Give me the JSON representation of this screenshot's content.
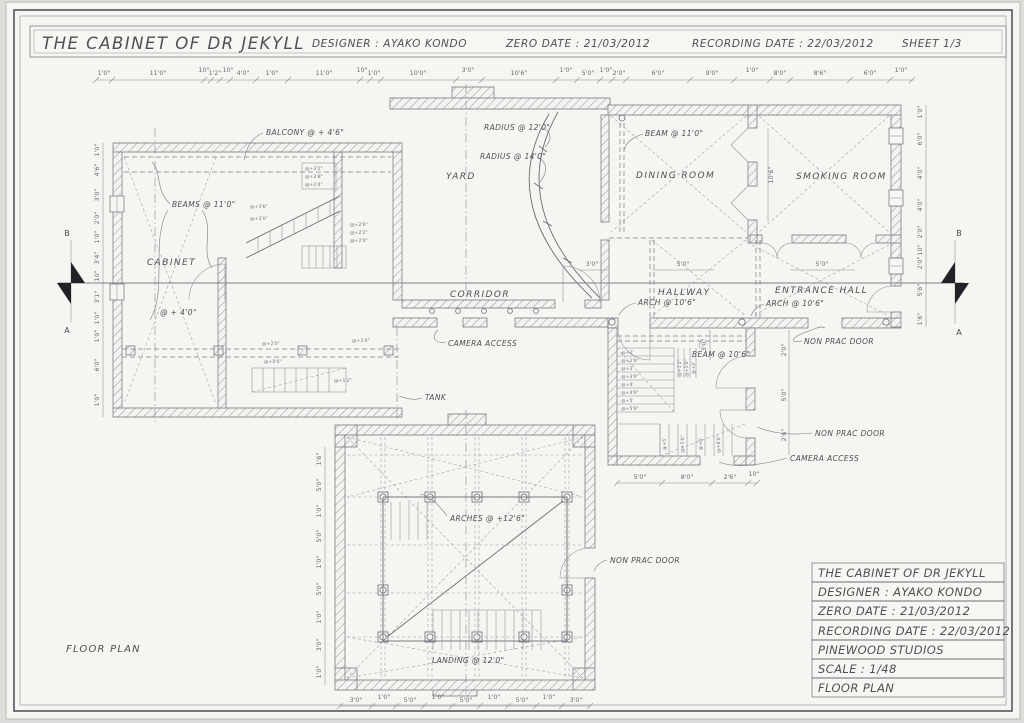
{
  "header": {
    "title": "THE CABINET OF DR JEKYLL",
    "designer": "DESIGNER : AYAKO KONDO",
    "zero_date": "ZERO DATE : 21/03/2012",
    "recording_date": "RECORDING DATE : 22/03/2012",
    "sheet": "SHEET  1/3"
  },
  "title_block": {
    "rows": [
      "THE CABINET OF DR JEKYLL",
      "DESIGNER : AYAKO KONDO",
      "ZERO DATE : 21/03/2012",
      "RECORDING DATE : 22/03/2012",
      "PINEWOOD STUDIOS",
      "SCALE : 1/48",
      "FLOOR PLAN"
    ]
  },
  "footer_label": "FLOOR PLAN",
  "rooms": {
    "cabinet": "CABINET",
    "yard": "YARD",
    "dining": "DINING ROOM",
    "smoking": "SMOKING ROOM",
    "corridor": "CORRIDOR",
    "hallway": "HALLWAY",
    "entrance": "ENTRANCE HALL"
  },
  "notes": {
    "balcony": "BALCONY @ + 4'6\"",
    "beams_11": "BEAMS @ 11'0\"",
    "beam_11": "BEAM @ 11'0\"",
    "radius_12": "RADIUS @ 12'0\"",
    "radius_14": "RADIUS @ 14'0\"",
    "arch_hall": "ARCH @ 10'6\"",
    "arch_entrance": "ARCH @ 10'6\"",
    "beam_106": "BEAM @ 10'6\"",
    "camera_access_1": "CAMERA ACCESS",
    "camera_access_2": "CAMERA ACCESS",
    "non_prac_1": "NON PRAC DOOR",
    "non_prac_2": "NON PRAC DOOR",
    "non_prac_3": "NON PRAC DOOR",
    "tank": "TANK",
    "arches": "ARCHES @ +12'6\"",
    "landing": "LANDING @ 12'0\"",
    "level4": "@ + 4'0\""
  },
  "section": {
    "a": "A",
    "b": "B"
  },
  "dims": {
    "top": [
      "1'0\"",
      "11'0\"",
      "10\"",
      "1'2\"",
      "10\"",
      "4'0\"",
      "1'0\"",
      "11'0\"",
      "10\"",
      "1'0\"",
      "10'0\"",
      "3'0\"",
      "10'6\"",
      "1'0\"",
      "5'0\"",
      "1'0\"",
      "2'0\"",
      "6'0\"",
      "9'0\"",
      "1'0\"",
      "8'0\"",
      "8'6\"",
      "6'0\"",
      "1'0\""
    ],
    "left": [
      "1'0\"",
      "4'6\"",
      "3'0\"",
      "2'0\"",
      "1'0\"",
      "3'4\"",
      "10\"",
      "3'1\"",
      "1'0\"",
      "1'0\"",
      "6'0\"",
      "1'0\""
    ],
    "right": [
      "1'0\"",
      "6'0\"",
      "4'0\"",
      "4'0\"",
      "2'0\"",
      "10\"",
      "2'0\"",
      "5'6\"",
      "1'6\""
    ],
    "tower_bottom": [
      "3'0\"",
      "1'0\"",
      "5'0\"",
      "1'0\"",
      "5'0\"",
      "1'0\"",
      "5'0\"",
      "1'0\"",
      "3'0\""
    ],
    "tower_left": [
      "1'6\"",
      "5'0\"",
      "1'0\"",
      "5'0\"",
      "1'0\"",
      "5'0\"",
      "1'0\"",
      "3'0\"",
      "1'0\""
    ],
    "stair_bottom": [
      "5'0\"",
      "8'0\"",
      "2'6\"",
      "10\""
    ],
    "stair_right": [
      "2'0\"",
      "5'0\"",
      "2'6\""
    ],
    "hall": [
      "3'0\"",
      "5'0\"",
      "5'0\""
    ],
    "smoking_height": "10'6\"",
    "stair_inner": "3'0\""
  },
  "stair_notes": {
    "left_flight": [
      "@+3'6\"",
      "@+3'0\""
    ],
    "left_stack": [
      "@+2'6\"",
      "@+2'2\"",
      "@+2'0\""
    ],
    "left_lower": [
      "@+2'0\"",
      "@+0'6\"",
      "@+1'2\"",
      "@+1'6\""
    ],
    "balcony_stack": [
      "@+3'2\"",
      "@+2'8\"",
      "@+2'4\""
    ],
    "right_flight": [
      "@+2'",
      "@+2'6\"",
      "@+3'",
      "@+3'6\"",
      "@+4'",
      "@+4'6\"",
      "@+5'",
      "@+5'6\""
    ],
    "right_side": [
      "@+1'2\"",
      "@+1'6\"",
      "@+2'"
    ],
    "right_lower": [
      "@+5'",
      "@+5'6\"",
      "@+6'",
      "@+6'6\""
    ]
  }
}
